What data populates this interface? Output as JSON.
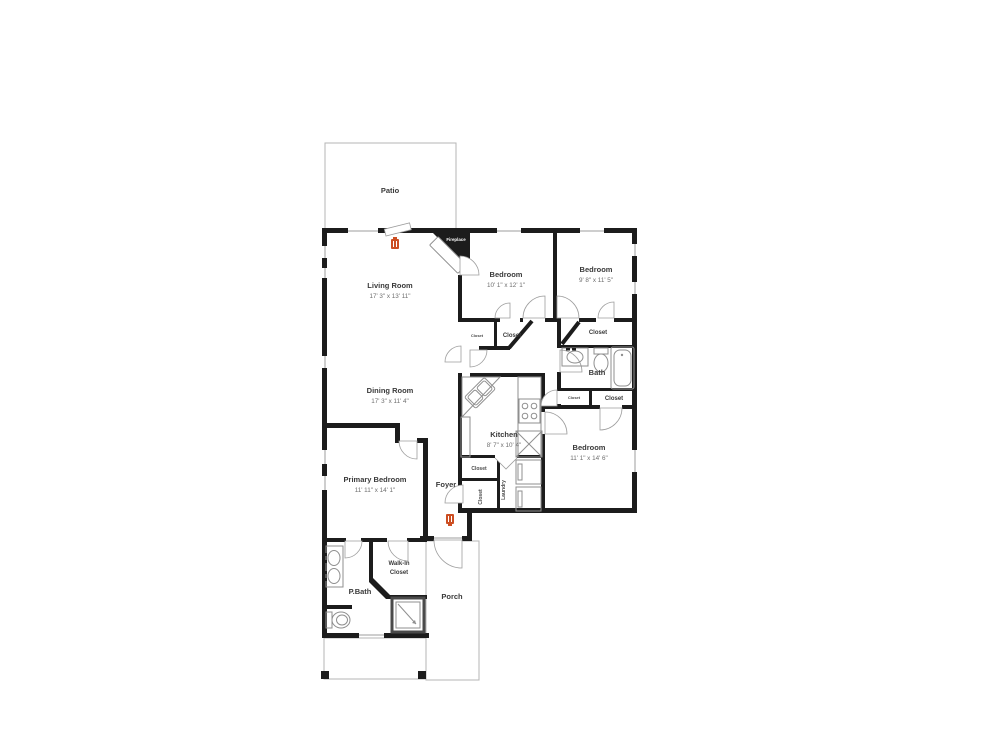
{
  "plan": {
    "patio": {
      "label": "Patio"
    },
    "living_room": {
      "label": "Living Room",
      "dims": "17' 3\" x 13' 11\""
    },
    "bedroom_top_middle": {
      "label": "Bedroom",
      "dims": "10' 1\" x 12' 1\""
    },
    "bedroom_top_right": {
      "label": "Bedroom",
      "dims": "9' 8\" x 11' 5\""
    },
    "dining_room": {
      "label": "Dining Room",
      "dims": "17' 3\" x 11' 4\""
    },
    "kitchen": {
      "label": "Kitchen",
      "dims": "8' 7\" x 10' 4\""
    },
    "bath": {
      "label": "Bath"
    },
    "bedroom_right": {
      "label": "Bedroom",
      "dims": "11' 1\" x 14' 6\""
    },
    "primary_bedroom": {
      "label": "Primary Bedroom",
      "dims": "11' 11\" x 14' 1\""
    },
    "foyer": {
      "label": "Foyer"
    },
    "laundry": {
      "label": "Laundry"
    },
    "p_bath": {
      "label": "P.Bath"
    },
    "walk_in_closet": {
      "label": "Walk-In Closet",
      "line1": "Walk-In",
      "line2": "Closet"
    },
    "porch": {
      "label": "Porch"
    },
    "fireplace": {
      "label": "Fireplace"
    },
    "closet_label": "Closet"
  },
  "colors": {
    "wall": "#1c1c1c",
    "thin_line": "#b5b5b5",
    "fixture_line": "#8f8f8f",
    "accent_icon": "#cc4e22",
    "room_text": "#3a3a3a",
    "dims_text": "#6e6e6e"
  }
}
